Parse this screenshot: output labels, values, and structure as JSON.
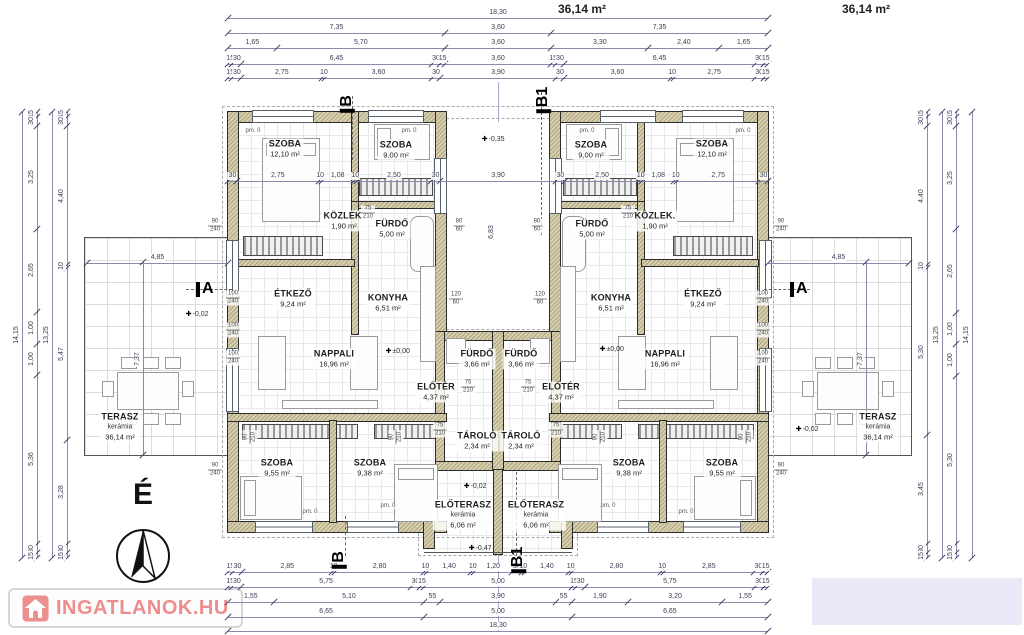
{
  "header": {
    "area_left": "36,14 m²",
    "area_right": "36,14 m²"
  },
  "north": {
    "label": "É"
  },
  "watermark": {
    "text": "INGATLANOK.HU"
  },
  "colors": {
    "wall_fill": "#d7cfad",
    "dim_line": "#8a8aad",
    "dim_text": "#3c3c55",
    "accent_red": "#ee8d8d",
    "cover_lavender": "#e9e9f7"
  },
  "plan": {
    "rooms": [
      {
        "name": "SZOBA",
        "area": "12,10 m²",
        "x": 285,
        "y": 149
      },
      {
        "name": "SZOBA",
        "area": "9,00 m²",
        "x": 396,
        "y": 150
      },
      {
        "name": "KÖZLEK.",
        "area": "1,90 m²",
        "x": 344,
        "y": 221
      },
      {
        "name": "FÜRDŐ",
        "area": "5,00 m²",
        "x": 392,
        "y": 229
      },
      {
        "name": "ÉTKEZŐ",
        "area": "9,24 m²",
        "x": 293,
        "y": 299
      },
      {
        "name": "KONYHA",
        "area": "6,51 m²",
        "x": 388,
        "y": 303
      },
      {
        "name": "NAPPALI",
        "area": "16,96 m²",
        "x": 334,
        "y": 359
      },
      {
        "name": "ELŐTÉR",
        "area": "4,37 m²",
        "x": 436,
        "y": 392
      },
      {
        "name": "FÜRDŐ",
        "area": "3,66 m²",
        "x": 477,
        "y": 359
      },
      {
        "name": "TÁROLÓ",
        "area": "2,34 m²",
        "x": 477,
        "y": 441
      },
      {
        "name": "SZOBA",
        "area": "9,55 m²",
        "x": 277,
        "y": 468
      },
      {
        "name": "SZOBA",
        "area": "9,38 m²",
        "x": 370,
        "y": 468
      },
      {
        "name": "ELŐTERASZ",
        "sub": "kerámia",
        "area": "6,06 m²",
        "x": 463,
        "y": 515
      },
      {
        "name": "TERASZ",
        "sub": "kerámia",
        "area": "36,14 m²",
        "x": 120,
        "y": 427
      },
      {
        "name": "SZOBA",
        "area": "9,00 m²",
        "x": 591,
        "y": 150
      },
      {
        "name": "SZOBA",
        "area": "12,10 m²",
        "x": 712,
        "y": 149
      },
      {
        "name": "FÜRDŐ",
        "area": "5,00 m²",
        "x": 592,
        "y": 229
      },
      {
        "name": "KÖZLEK.",
        "area": "1,90 m²",
        "x": 655,
        "y": 221
      },
      {
        "name": "KONYHA",
        "area": "6,51 m²",
        "x": 611,
        "y": 303
      },
      {
        "name": "ÉTKEZŐ",
        "area": "9,24 m²",
        "x": 703,
        "y": 299
      },
      {
        "name": "NAPPALI",
        "area": "16,96 m²",
        "x": 665,
        "y": 359
      },
      {
        "name": "ELŐTÉR",
        "area": "4,37 m²",
        "x": 561,
        "y": 392
      },
      {
        "name": "FÜRDŐ",
        "area": "3,66 m²",
        "x": 521,
        "y": 359
      },
      {
        "name": "TÁROLÓ",
        "area": "2,34 m²",
        "x": 521,
        "y": 441
      },
      {
        "name": "SZOBA",
        "area": "9,38 m²",
        "x": 629,
        "y": 468
      },
      {
        "name": "SZOBA",
        "area": "9,55 m²",
        "x": 722,
        "y": 468
      },
      {
        "name": "ELŐTERASZ",
        "sub": "kerámia",
        "area": "6,06 m²",
        "x": 536,
        "y": 515
      },
      {
        "name": "TERASZ",
        "sub": "kerámia",
        "area": "36,14 m²",
        "x": 878,
        "y": 427
      }
    ],
    "levels": [
      {
        "text": "-0,35",
        "x": 484,
        "y": 139
      },
      {
        "text": "±0,00",
        "x": 388,
        "y": 351
      },
      {
        "text": "±0,00",
        "x": 602,
        "y": 349
      },
      {
        "text": "-0,02",
        "x": 188,
        "y": 314
      },
      {
        "text": "-0,02",
        "x": 798,
        "y": 429
      },
      {
        "text": "-0,02",
        "x": 466,
        "y": 486
      },
      {
        "text": "-0,47",
        "x": 471,
        "y": 548
      }
    ],
    "loose_labels": [
      {
        "text": "6,83",
        "x": 492,
        "y": 232,
        "rot": -90
      }
    ],
    "markers": [
      {
        "text": "A",
        "x": 196,
        "y": 281,
        "rot": 0
      },
      {
        "text": "A",
        "x": 790,
        "y": 281,
        "rot": 0
      },
      {
        "text": "B",
        "x": 338,
        "y": 96,
        "rot": -90
      },
      {
        "text": "B1",
        "x": 530,
        "y": 92,
        "rot": -90
      },
      {
        "text": "B",
        "x": 330,
        "y": 552,
        "rot": -90
      },
      {
        "text": "B1",
        "x": 505,
        "y": 552,
        "rot": -90
      }
    ],
    "size_tags": [
      {
        "a": "90",
        "b": "240",
        "x": 215,
        "y": 226
      },
      {
        "a": "90",
        "b": "240",
        "x": 215,
        "y": 470
      },
      {
        "a": "90",
        "b": "240",
        "x": 781,
        "y": 226
      },
      {
        "a": "90",
        "b": "240",
        "x": 781,
        "y": 470
      },
      {
        "a": "100",
        "b": "240",
        "x": 233,
        "y": 298
      },
      {
        "a": "100",
        "b": "240",
        "x": 233,
        "y": 330
      },
      {
        "a": "100",
        "b": "240",
        "x": 233,
        "y": 358
      },
      {
        "a": "100",
        "b": "240",
        "x": 763,
        "y": 298
      },
      {
        "a": "100",
        "b": "240",
        "x": 763,
        "y": 330
      },
      {
        "a": "100",
        "b": "240",
        "x": 763,
        "y": 358
      },
      {
        "a": "75",
        "b": "210",
        "x": 368,
        "y": 213
      },
      {
        "a": "75",
        "b": "210",
        "x": 628,
        "y": 213
      },
      {
        "a": "75",
        "b": "210",
        "x": 468,
        "y": 387
      },
      {
        "a": "75",
        "b": "210",
        "x": 528,
        "y": 387
      },
      {
        "a": "75",
        "b": "210",
        "x": 440,
        "y": 430
      },
      {
        "a": "75",
        "b": "210",
        "x": 556,
        "y": 430
      },
      {
        "a": "80",
        "b": "60",
        "x": 459,
        "y": 226
      },
      {
        "a": "80",
        "b": "60",
        "x": 537,
        "y": 226
      },
      {
        "a": "120",
        "b": "60",
        "x": 456,
        "y": 299
      },
      {
        "a": "120",
        "b": "60",
        "x": 540,
        "y": 299
      }
    ],
    "size_tags_rot": [
      {
        "a": "90",
        "b": "210",
        "x": 250,
        "y": 437
      },
      {
        "a": "90",
        "b": "210",
        "x": 396,
        "y": 437
      },
      {
        "a": "90",
        "b": "210",
        "x": 600,
        "y": 437
      },
      {
        "a": "90",
        "b": "210",
        "x": 746,
        "y": 437
      }
    ],
    "pm_tags": [
      {
        "text": "pm. 0",
        "x": 253,
        "y": 131
      },
      {
        "text": "pm. 0",
        "x": 409,
        "y": 131
      },
      {
        "text": "pm. 0",
        "x": 587,
        "y": 131
      },
      {
        "text": "pm. 0",
        "x": 743,
        "y": 131
      },
      {
        "text": "pm. 0",
        "x": 310,
        "y": 512
      },
      {
        "text": "pm. 0",
        "x": 388,
        "y": 506
      },
      {
        "text": "pm. 0",
        "x": 608,
        "y": 506
      },
      {
        "text": "pm. 0",
        "x": 686,
        "y": 512
      }
    ],
    "dims": [
      {
        "o": "h",
        "x": 228,
        "y": 18,
        "len": 540,
        "segs": [
          18.3
        ]
      },
      {
        "o": "h",
        "x": 228,
        "y": 33,
        "len": 540,
        "segs": [
          7.35,
          3.6,
          7.35
        ]
      },
      {
        "o": "h",
        "x": 228,
        "y": 48,
        "len": 540,
        "segs": [
          1.65,
          5.7,
          3.6,
          3.3,
          2.4,
          1.65
        ]
      },
      {
        "o": "h",
        "x": 228,
        "y": 64,
        "len": 540,
        "segs": [
          0.15,
          0.3,
          6.45,
          0.3,
          0.15,
          3.6,
          0.15,
          0.3,
          6.45,
          0.3,
          0.15
        ]
      },
      {
        "o": "h",
        "x": 228,
        "y": 78,
        "len": 540,
        "segs": [
          0.15,
          0.3,
          2.75,
          0.1,
          3.6,
          0.3,
          3.9,
          0.3,
          3.6,
          0.1,
          2.75,
          0.3,
          0.15
        ]
      },
      {
        "o": "h",
        "x": 228,
        "y": 181,
        "len": 540,
        "segs": [
          0.3,
          2.75,
          0.1,
          1.08,
          0.1,
          2.5,
          0.3,
          3.9,
          0.3,
          2.5,
          0.1,
          1.08,
          0.1,
          2.75,
          0.3
        ]
      },
      {
        "o": "h",
        "x": 228,
        "y": 572,
        "len": 540,
        "segs": [
          0.15,
          0.3,
          2.85,
          0.1,
          2.8,
          0.1,
          1.4,
          0.1,
          1.2,
          0.3,
          0.1,
          1.4,
          0.1,
          2.8,
          0.1,
          2.85,
          0.3,
          0.15
        ]
      },
      {
        "o": "h",
        "x": 228,
        "y": 587,
        "len": 540,
        "segs": [
          0.15,
          0.3,
          5.75,
          0.3,
          0.15,
          5.0,
          0.15,
          0.3,
          5.75,
          0.3,
          0.15
        ]
      },
      {
        "o": "h",
        "x": 228,
        "y": 602,
        "len": 540,
        "segs": [
          1.55,
          5.1,
          0.55,
          3.9,
          0.55,
          1.9,
          3.2,
          1.55
        ]
      },
      {
        "o": "h",
        "x": 228,
        "y": 617,
        "len": 540,
        "segs": [
          6.65,
          5.0,
          6.65
        ]
      },
      {
        "o": "h",
        "x": 228,
        "y": 631,
        "len": 540,
        "segs": [
          18.3
        ]
      },
      {
        "o": "h",
        "x": 87,
        "y": 263,
        "len": 141,
        "segs": [
          4.85
        ]
      },
      {
        "o": "h",
        "x": 768,
        "y": 263,
        "len": 141,
        "segs": [
          4.85
        ]
      },
      {
        "o": "v",
        "x": 22,
        "y": 112,
        "len": 446,
        "segs": [
          14.15
        ]
      },
      {
        "o": "v",
        "x": 37,
        "y": 112,
        "len": 446,
        "segs": [
          0.15,
          0.3,
          3.25,
          2.65,
          1.0,
          1.0,
          5.36,
          0.3,
          0.15
        ]
      },
      {
        "o": "v",
        "x": 52,
        "y": 112,
        "len": 446,
        "segs": [
          13.25
        ]
      },
      {
        "o": "v",
        "x": 67,
        "y": 112,
        "len": 446,
        "segs": [
          0.15,
          0.3,
          4.4,
          0.1,
          5.47,
          3.28,
          0.3,
          0.15
        ]
      },
      {
        "o": "v",
        "x": 927,
        "y": 112,
        "len": 446,
        "segs": [
          0.15,
          0.3,
          4.4,
          0.1,
          5.3,
          3.45,
          0.3,
          0.15
        ]
      },
      {
        "o": "v",
        "x": 942,
        "y": 112,
        "len": 446,
        "segs": [
          13.25
        ]
      },
      {
        "o": "v",
        "x": 956,
        "y": 112,
        "len": 446,
        "segs": [
          0.15,
          0.3,
          3.25,
          2.65,
          1.0,
          1.0,
          5.3,
          0.3,
          0.15
        ]
      },
      {
        "o": "v",
        "x": 972,
        "y": 112,
        "len": 446,
        "segs": [
          14.15
        ]
      },
      {
        "o": "v",
        "x": 143,
        "y": 262,
        "len": 193,
        "segs": [
          7.37
        ]
      },
      {
        "o": "v",
        "x": 866,
        "y": 262,
        "len": 193,
        "segs": [
          7.37
        ]
      }
    ]
  }
}
